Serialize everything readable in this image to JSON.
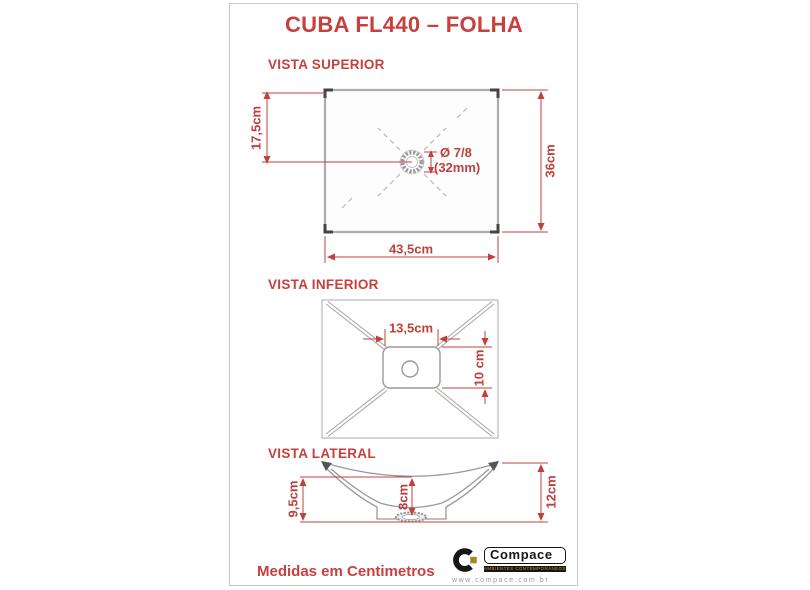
{
  "title": "CUBA FL440 – FOLHA",
  "footer": {
    "note": "Medidas em Centimetros"
  },
  "colors": {
    "accent_red": "#c0403d",
    "drawing_gray": "#9a9a9a",
    "panel_border": "#c9c9c9"
  },
  "views": {
    "superior": {
      "label": "VISTA SUPERIOR",
      "dim_left": "17,5cm",
      "dim_right": "36cm",
      "dim_bottom": "43,5cm",
      "drain_diameter_line1": "Ø 7/8",
      "drain_diameter_line2": "(32mm)"
    },
    "inferior": {
      "label": "VISTA INFERIOR",
      "dim_top": "13,5cm",
      "dim_right": "10 cm"
    },
    "lateral": {
      "label": "VISTA LATERAL",
      "dim_left": "9,5cm",
      "dim_center": "8cm",
      "dim_right": "12cm"
    }
  },
  "logo": {
    "brand": "Compace",
    "tagline": "ambientes contemporâneos",
    "website": "www.compace.com.br"
  }
}
